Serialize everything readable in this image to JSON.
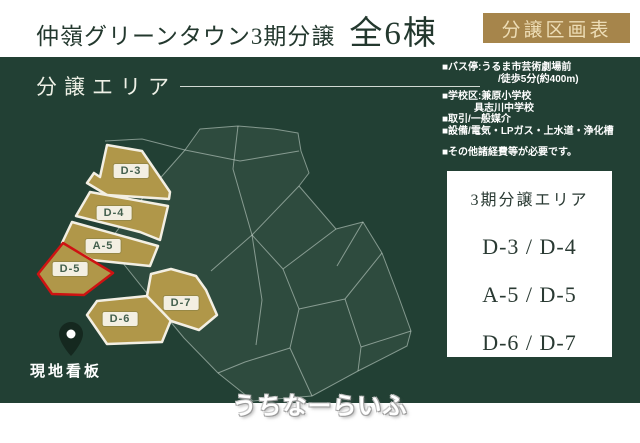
{
  "header": {
    "title": "仲嶺グリーンタウン3期分譲",
    "units": "全6棟",
    "badge": "分譲区画表"
  },
  "map": {
    "area_label": "分譲エリア",
    "info_lines": [
      "■バス停:うるま市芸術劇場前",
      "/徒歩5分(約400m)",
      "■学校区:兼原小学校",
      "具志川中学校",
      "■取引/一般媒介",
      "■設備/電気・LPガス・上水道・浄化槽",
      "■その他諸経費等が必要です。"
    ],
    "pin_label": "現地看板",
    "lots": [
      {
        "id": "D-3",
        "highlighted": false
      },
      {
        "id": "D-4",
        "highlighted": false
      },
      {
        "id": "A-5",
        "highlighted": false
      },
      {
        "id": "D-5",
        "highlighted": true
      },
      {
        "id": "D-6",
        "highlighted": false
      },
      {
        "id": "D-7",
        "highlighted": false
      }
    ]
  },
  "side_panel": {
    "title": "3期分譲エリア",
    "rows": [
      "D-3 / D-4",
      "A-5 / D-5",
      "D-6 / D-7"
    ]
  },
  "watermark": "うちなーらいふ",
  "colors": {
    "badge_gold": "#a6854b",
    "lot_gold": "#b09749",
    "lot_border_cream": "#f3efe3",
    "highlight_red": "#ce1212",
    "panel_green": "#224034"
  }
}
